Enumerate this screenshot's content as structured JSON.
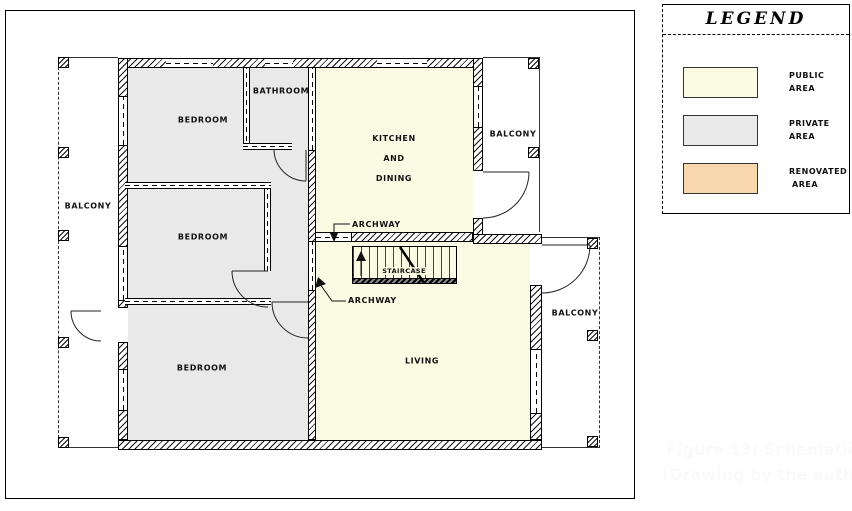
{
  "plan": {
    "colors": {
      "public": "#FBFBE4",
      "private": "#E9E9E9",
      "renovated": "#F8D7AF"
    },
    "rooms": {
      "bedroom_top": {
        "label": "BEDROOM"
      },
      "bedroom_middle": {
        "label": "BEDROOM"
      },
      "bedroom_bottom": {
        "label": "BEDROOM"
      },
      "bathroom": {
        "label": "BATHROOM"
      },
      "kitchen": {
        "line1": "KITCHEN",
        "line2": "AND",
        "line3": "DINING"
      },
      "living": {
        "label": "LIVING"
      },
      "staircase": {
        "label": "STAIRCASE"
      }
    },
    "balconies": {
      "left": {
        "label": "BALCONY"
      },
      "top_right": {
        "label": "BALCONY"
      },
      "bottom_right": {
        "label": "BALCONY"
      }
    },
    "annotations": {
      "archway_top": {
        "label": "ARCHWAY"
      },
      "archway_bottom": {
        "label": "ARCHWAY"
      }
    }
  },
  "legend": {
    "title": "LEGEND",
    "items": [
      {
        "name": "public",
        "line1": "PUBLIC",
        "line2": "AREA",
        "color": "#FBFBE4"
      },
      {
        "name": "private",
        "line1": "PRIVATE",
        "line2": "AREA",
        "color": "#E9E9E9"
      },
      {
        "name": "renovated",
        "line1": "RENOVATED",
        "line2": "AREA",
        "color": "#F8D7AF"
      }
    ]
  },
  "caption": {
    "line1": "Figure 13: Schematic",
    "line2": "(Drawing by the auth"
  }
}
